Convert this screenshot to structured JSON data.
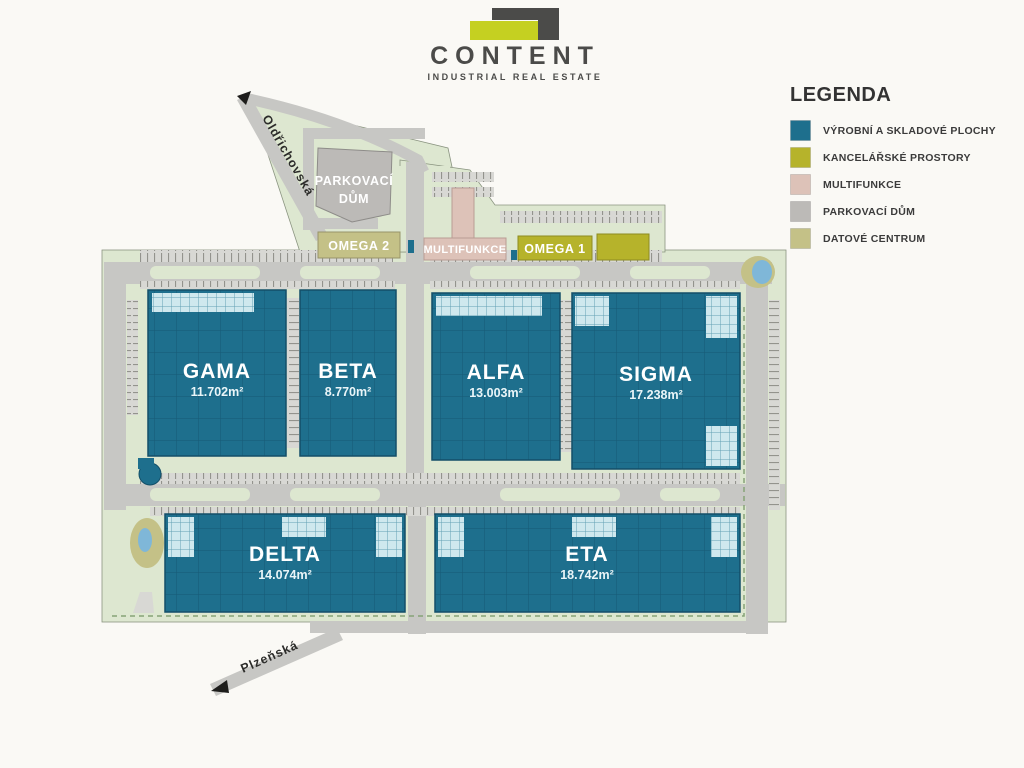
{
  "logo": {
    "title": "CONTENT",
    "subtitle": "INDUSTRIAL REAL ESTATE"
  },
  "legend": {
    "title": "LEGENDA",
    "items": [
      {
        "label": "VÝROBNÍ A SKLADOVÉ PLOCHY",
        "color": "#1e6f8d"
      },
      {
        "label": "KANCELÁŘSKÉ PROSTORY",
        "color": "#b6b32b"
      },
      {
        "label": "MULTIFUNKCE",
        "color": "#ddc2b8"
      },
      {
        "label": "PARKOVACÍ DŮM",
        "color": "#bcbab7"
      },
      {
        "label": "DATOVÉ CENTRUM",
        "color": "#c4c187"
      }
    ]
  },
  "colors": {
    "production": "#1e6f8d",
    "office": "#b6b32b",
    "multifunction": "#ddc2b8",
    "parking_house": "#bcbab7",
    "data_center": "#c4c187",
    "mezzanine": "#cfe8ee",
    "water": "#7fb7d8",
    "site_green": "#dde7d0",
    "road_gray": "#c7c7c4",
    "logo_dark": "#4b4b49",
    "accent_yellow": "#c5d021"
  },
  "streets": {
    "oldrichovska": "Oldřichovská",
    "plzenska": "Plzeňská"
  },
  "halls": [
    {
      "name": "GAMA",
      "area": "11.702m²"
    },
    {
      "name": "BETA",
      "area": "8.770m²"
    },
    {
      "name": "ALFA",
      "area": "13.003m²"
    },
    {
      "name": "SIGMA",
      "area": "17.238m²"
    },
    {
      "name": "DELTA",
      "area": "14.074m²"
    },
    {
      "name": "ETA",
      "area": "18.742m²"
    }
  ],
  "top_structures": {
    "parkovaci_dum_line1": "PARKOVACÍ",
    "parkovaci_dum_line2": "DŮM",
    "omega2": "OMEGA 2",
    "multifunkce": "MULTIFUNKCE",
    "omega1": "OMEGA 1"
  }
}
